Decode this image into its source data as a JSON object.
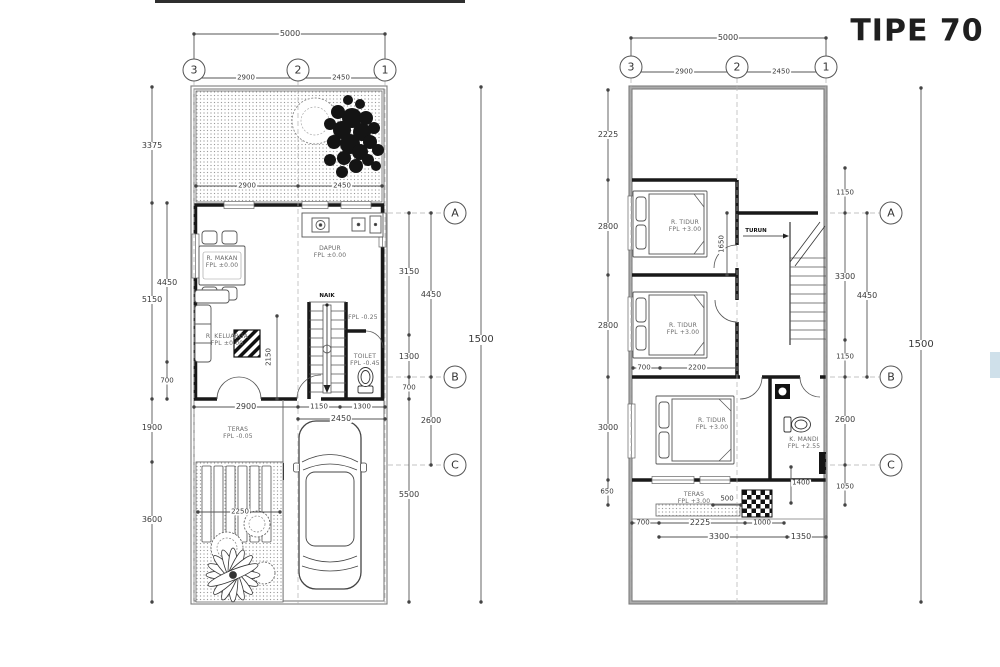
{
  "title": "TIPE 70",
  "ground": {
    "grid_top": [
      "3",
      "2",
      "1"
    ],
    "grid_side": [
      "A",
      "B",
      "C"
    ],
    "dims": {
      "total_w": "5000",
      "w1": "2900",
      "w2": "2450",
      "l1": "3375",
      "l2": "5150",
      "l3": "4450",
      "l4": "700",
      "l5": "1900",
      "l6": "3600",
      "r1": "3150",
      "r2": "4450",
      "r3": "1300",
      "r4": "700",
      "r5": "2600",
      "r6": "5500",
      "total_h": "1500",
      "b1": "2900",
      "b2": "1150",
      "b3": "1300",
      "b4": "2450",
      "garden_w1": "2900",
      "garden_w2": "2450",
      "stair": "2150",
      "deck": "2250"
    },
    "rooms": {
      "dapur": {
        "name": "DAPUR",
        "level": "FPL ±0.00"
      },
      "makan": {
        "name": "R. MAKAN",
        "level": "FPL ±0.00"
      },
      "keluarga": {
        "name": "R. KELUARGA",
        "level": "FPL ±0.00"
      },
      "toilet": {
        "name": "TOILET",
        "level": "FPL -0.45"
      },
      "teras": {
        "name": "TERAS",
        "level": "FPL -0.05"
      },
      "hall_level": "FPL -0.25",
      "stair_label": "NAIK"
    }
  },
  "upper": {
    "grid_top": [
      "3",
      "2",
      "1"
    ],
    "grid_side": [
      "A",
      "B",
      "C"
    ],
    "dims": {
      "total_w": "5000",
      "w1": "2900",
      "w2": "2450",
      "l1": "2225",
      "l2": "2800",
      "l3": "2800",
      "l4": "3000",
      "l5": "650",
      "r1": "1150",
      "r2": "3300",
      "r3": "4450",
      "r4": "1150",
      "r5": "2600",
      "r6": "1050",
      "total_h": "1500",
      "b1": "700",
      "b2": "2225",
      "b3": "1000",
      "b4": "3300",
      "b5": "1350",
      "i1": "1650",
      "i2": "700",
      "i3": "2200",
      "i4": "500",
      "i5": "1400"
    },
    "rooms": {
      "tidur1": {
        "name": "R. TIDUR",
        "level": "FPL +3.00"
      },
      "tidur2": {
        "name": "R. TIDUR",
        "level": "FPL +3.00"
      },
      "tidur3": {
        "name": "R. TIDUR",
        "level": "FPL +3.00"
      },
      "mandi": {
        "name": "K. MANDI",
        "level": "FPL +2.55"
      },
      "teras": {
        "name": "TERAS",
        "level": "FPL +3.00"
      },
      "stair_label": "TURUN"
    }
  }
}
